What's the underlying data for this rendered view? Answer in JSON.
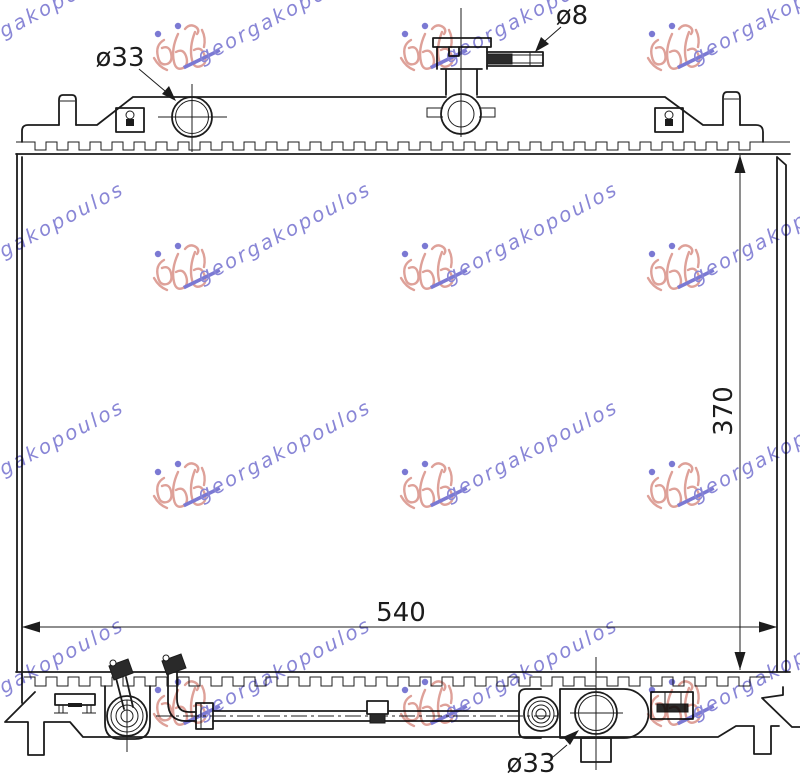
{
  "drawing": {
    "line_color": "#1c1c1c",
    "background_color": "#ffffff",
    "labels": {
      "cap_diameter": "ø33",
      "overflow_pipe_diameter": "ø8",
      "height": "370",
      "width": "540",
      "outlet_diameter": "ø33"
    }
  },
  "watermark": {
    "text": "georgakopoulos",
    "text_color": "#6b68cc",
    "logo_color": "#d6897f",
    "underline_color": "#5a57c8"
  }
}
